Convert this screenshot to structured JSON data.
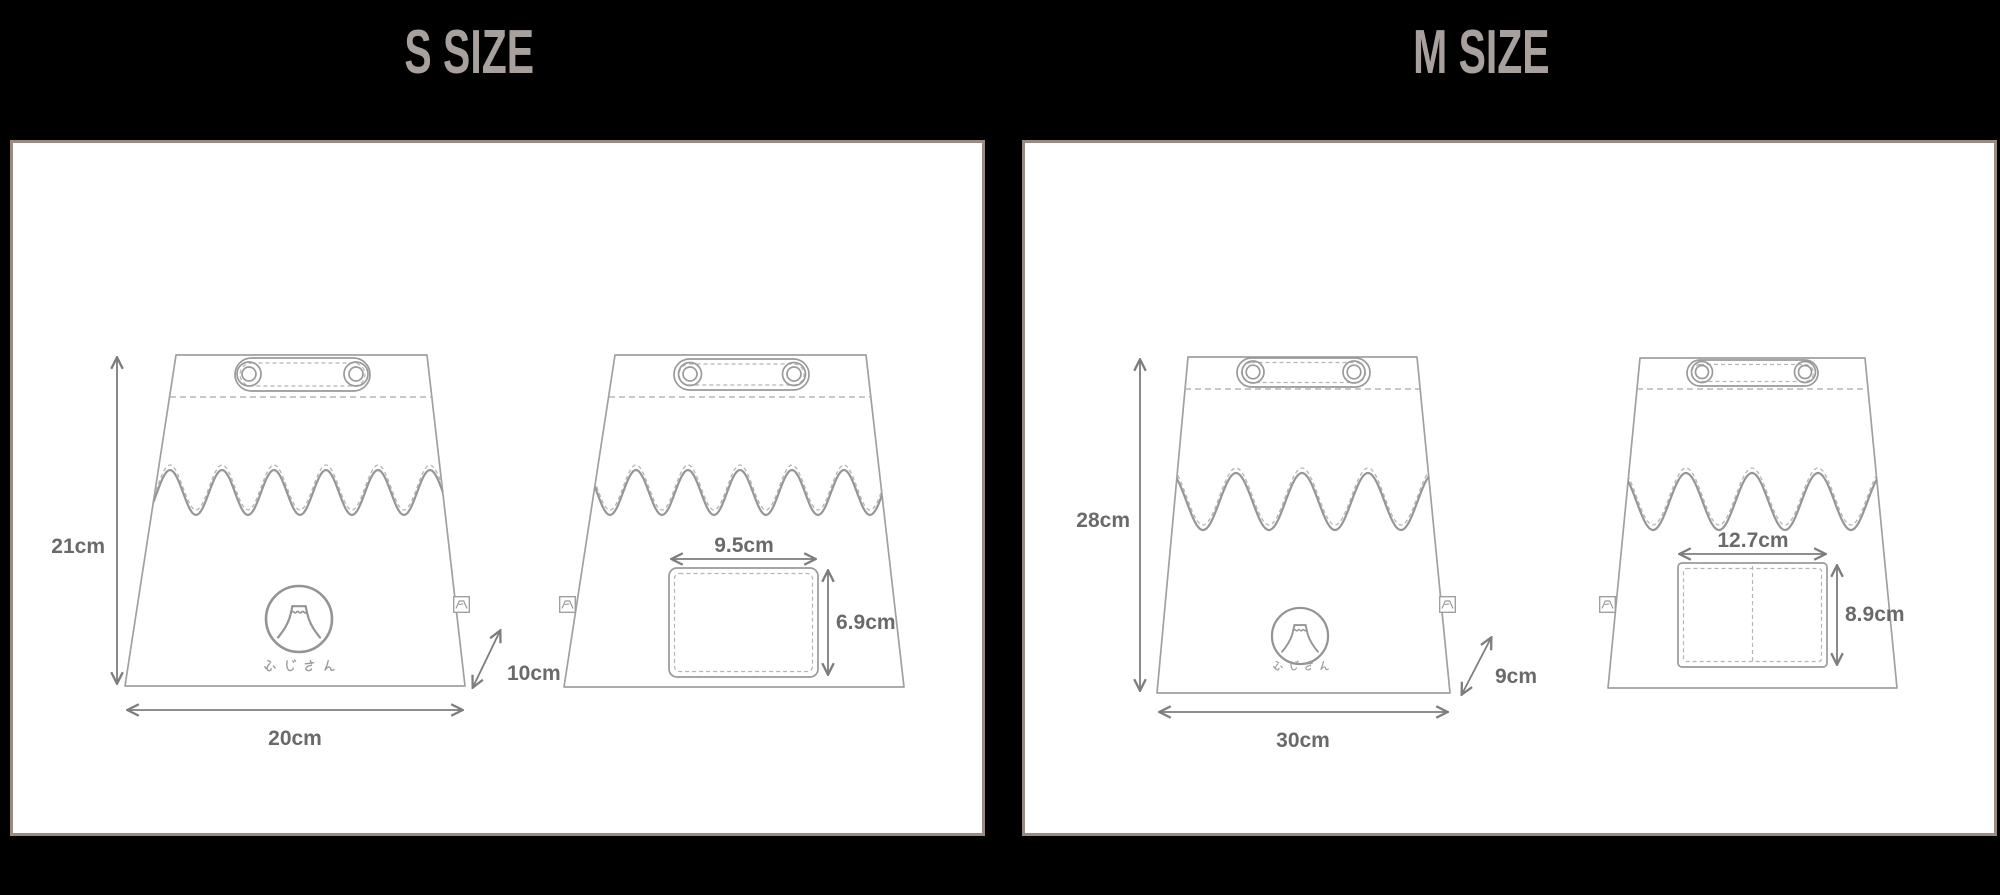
{
  "panels": [
    {
      "title": "S SIZE",
      "front_view": {
        "height": "21cm",
        "width": "20cm",
        "depth": "10cm",
        "logo_caption": "ふじさん"
      },
      "back_view": {
        "pocket_width": "9.5cm",
        "pocket_height": "6.9cm"
      }
    },
    {
      "title": "M SIZE",
      "front_view": {
        "height": "28cm",
        "width": "30cm",
        "depth": "9cm",
        "logo_caption": "ふじさん"
      },
      "back_view": {
        "pocket_width": "12.7cm",
        "pocket_height": "8.9cm"
      }
    }
  ],
  "colors": {
    "background": "#000000",
    "panel_background": "#ffffff",
    "panel_border": "#9a8a82",
    "title_text": "#a8a09c",
    "line": "#a0a0a0",
    "dimension_text": "#6a6a6a"
  }
}
